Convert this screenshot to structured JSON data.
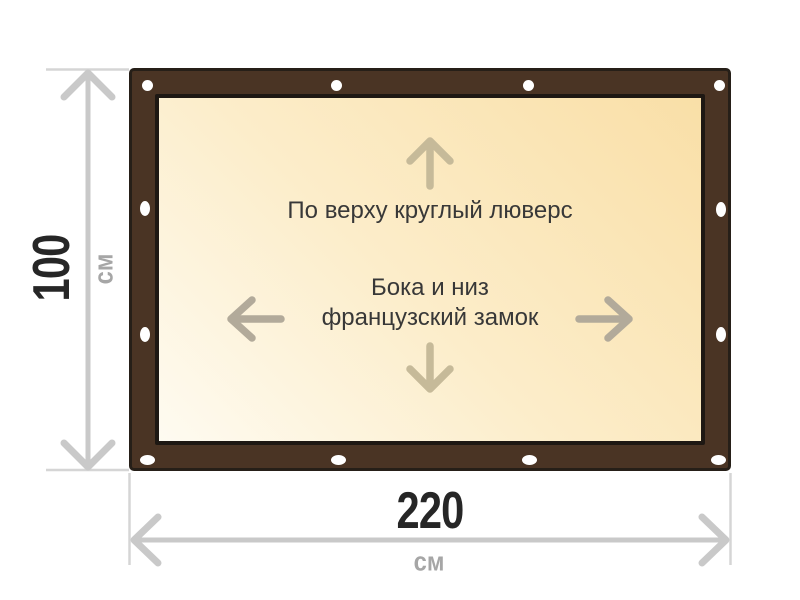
{
  "diagram": {
    "banner": {
      "top_label": "По верху круглый люверс",
      "center_label_line1": "Бока и низ",
      "center_label_line2": "французский замок",
      "grommet_count": 12
    },
    "dimensions": {
      "height": {
        "value": "100",
        "unit": "см"
      },
      "width": {
        "value": "220",
        "unit": "см"
      }
    },
    "colors": {
      "frame_brown": "#4a3424",
      "frame_outline": "#261f18",
      "canvas_gradient_light": "#fefbf1",
      "canvas_gradient_dark": "#f9dfa7",
      "inner_arrow_updown": "#c6ba99",
      "inner_arrow_leftright": "#b2aa9a",
      "dimension_line_gray": "#c9c9c9",
      "extension_line_gray": "#d5d5d5",
      "value_text": "#262626",
      "unit_text": "#a6a6a6",
      "label_text": "#383838",
      "grommet_white": "#ffffff"
    }
  }
}
